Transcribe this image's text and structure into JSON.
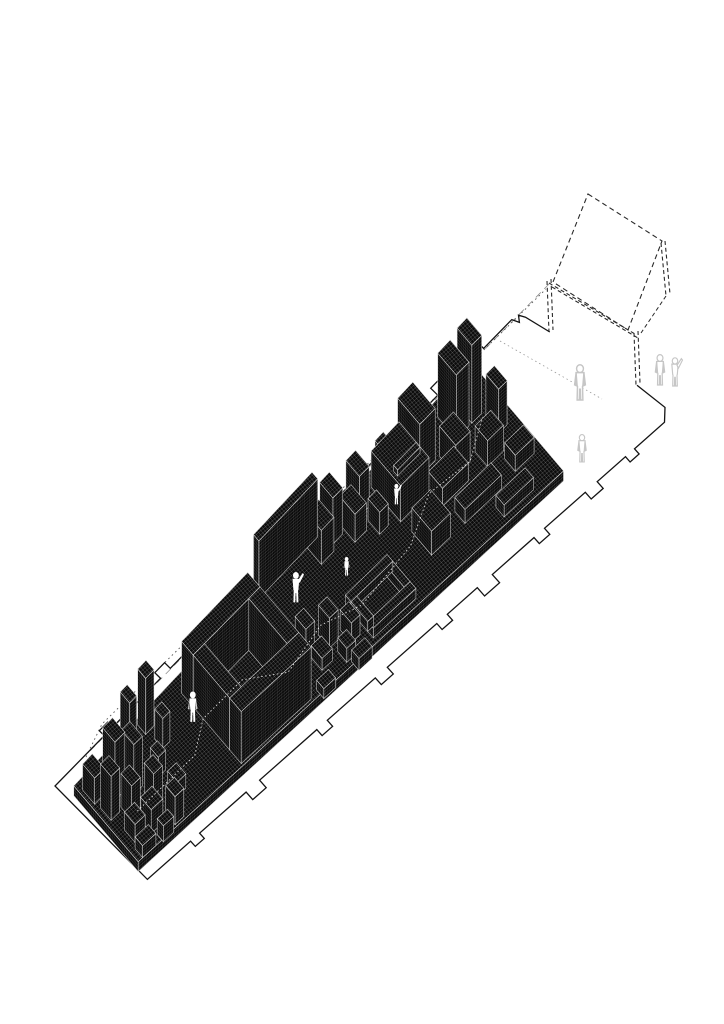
{
  "meta": {
    "title": "Axonometric site massing diagram",
    "description": "Black cross-hatched axonometric building massing on a long notched site plan, with dashed construction planes at the upper right and small human silhouettes"
  },
  "canvas": {
    "width": 724,
    "height": 1024,
    "background": "#ffffff"
  },
  "palette": {
    "line": "#141414",
    "dashed": "#2a2a2a",
    "construction_dash": "#8e8e8e",
    "construction_dot": "#555555",
    "leader": "#9a9a9a",
    "mass_fill": "#0c0c0c",
    "hatch_line": "#ffffff",
    "route_dot": "#ffffff",
    "ghost_outline": "#c6c6c6",
    "figure_fill": "#ffffff"
  },
  "axes": {
    "origin": [
      55,
      786
    ],
    "u": [
      0.7625,
      -0.6471
    ],
    "v": [
      0.6471,
      0.7625
    ],
    "strip_length": 650,
    "edge_nw": {
      "v0": 16,
      "dv": -76
    },
    "edge_se": {
      "v0": 131,
      "dv": -20
    }
  },
  "boundary": {
    "stroke_width": 1.3,
    "segments": [
      {
        "type": "line",
        "pts": [
          [
            703,
            71
          ],
          [
            710,
            106
          ],
          [
            700,
            117
          ]
        ]
      },
      {
        "type": "tabbed",
        "from": [
          700,
          117
        ],
        "to": [
          10,
          131
        ],
        "normal": [
          0.02,
          1
        ],
        "tabs": [
          [
            0.058,
            12,
            7
          ],
          [
            0.13,
            16,
            9
          ],
          [
            0.232,
            14,
            8
          ],
          [
            0.333,
            20,
            11
          ],
          [
            0.42,
            14,
            8
          ],
          [
            0.536,
            16,
            9
          ],
          [
            0.652,
            14,
            8
          ],
          [
            0.783,
            18,
            10
          ],
          [
            0.899,
            12,
            7
          ]
        ]
      },
      {
        "type": "line",
        "pts": [
          [
            10,
            131
          ],
          [
            0,
            0
          ]
        ]
      },
      {
        "type": "tabbed",
        "from": [
          0,
          0
        ],
        "to": [
          650,
          -60
        ],
        "normal": [
          -0.09,
          -0.996
        ],
        "tabs": [
          [
            0.108,
            12,
            7
          ],
          [
            0.231,
            14,
            8
          ],
          [
            0.346,
            16,
            9
          ],
          [
            0.462,
            20,
            11
          ],
          [
            0.569,
            14,
            8
          ],
          [
            0.662,
            16,
            9
          ],
          [
            0.738,
            14,
            8
          ],
          [
            0.838,
            18,
            10
          ],
          [
            0.923,
            10,
            6
          ]
        ]
      },
      {
        "type": "line",
        "pts": [
          [
            654,
            -53
          ],
          [
            658,
            -59
          ],
          [
            662,
            -53
          ],
          [
            671,
            -26
          ]
        ]
      }
    ]
  },
  "construction": {
    "dotted_boundary": [
      [
        86,
        757
      ],
      [
        102,
        724
      ],
      [
        546,
        289
      ]
    ],
    "dash_line": [
      [
        90,
        751
      ],
      [
        550,
        283
      ]
    ],
    "leader": [
      [
        500,
        341
      ],
      [
        602,
        399
      ]
    ],
    "panel": [
      [
        588,
        194
      ],
      [
        662,
        241
      ],
      [
        628,
        330
      ],
      [
        553,
        282
      ]
    ],
    "double_dash": [
      [
        [
          547,
          281
        ],
        [
          549,
          332
        ]
      ],
      [
        [
          551,
          279
        ],
        [
          553,
          330
        ]
      ],
      [
        [
          634,
          333
        ],
        [
          636,
          385
        ]
      ],
      [
        [
          638,
          331
        ],
        [
          640,
          383
        ]
      ],
      [
        [
          549,
          283
        ],
        [
          635,
          334
        ]
      ],
      [
        [
          552,
          287
        ],
        [
          638,
          338
        ]
      ],
      [
        [
          661,
          243
        ],
        [
          666,
          296
        ]
      ],
      [
        [
          665,
          241
        ],
        [
          670,
          294
        ]
      ]
    ],
    "single_dash": [
      [
        666,
        296
      ],
      [
        641,
        333
      ]
    ]
  },
  "massing": {
    "plinth": {
      "s0": 8,
      "s1": 585,
      "t0": 4,
      "t1": 90,
      "h": 10
    },
    "boxes": [
      [
        12,
        12,
        14,
        16,
        26
      ],
      [
        14,
        34,
        12,
        14,
        44
      ],
      [
        30,
        22,
        14,
        16,
        58
      ],
      [
        30,
        46,
        12,
        14,
        34
      ],
      [
        48,
        30,
        12,
        16,
        50
      ],
      [
        18,
        62,
        14,
        14,
        18
      ],
      [
        36,
        66,
        16,
        14,
        24
      ],
      [
        52,
        56,
        12,
        12,
        38
      ],
      [
        14,
        80,
        18,
        10,
        12
      ],
      [
        40,
        84,
        14,
        8,
        16
      ],
      [
        60,
        76,
        12,
        12,
        28
      ],
      [
        64,
        14,
        10,
        12,
        62
      ],
      [
        78,
        40,
        10,
        10,
        20
      ],
      [
        80,
        60,
        12,
        12,
        14
      ],
      [
        96,
        8,
        12,
        10,
        56
      ],
      [
        100,
        26,
        10,
        10,
        30
      ],
      [
        150,
        16,
        95,
        14,
        52
      ],
      [
        150,
        74,
        95,
        14,
        52
      ],
      [
        150,
        30,
        16,
        44,
        52
      ],
      [
        229,
        30,
        16,
        44,
        52
      ],
      [
        270,
        3,
        85,
        6,
        58
      ],
      [
        255,
        55,
        12,
        12,
        16
      ],
      [
        272,
        48,
        12,
        12,
        22
      ],
      [
        272,
        66,
        14,
        12,
        12
      ],
      [
        292,
        58,
        12,
        12,
        30
      ],
      [
        296,
        76,
        12,
        10,
        14
      ],
      [
        312,
        66,
        12,
        12,
        20
      ],
      [
        255,
        86,
        16,
        8,
        10
      ],
      [
        300,
        88,
        18,
        8,
        12
      ],
      [
        332,
        56,
        58,
        6,
        10
      ],
      [
        332,
        80,
        58,
        6,
        10
      ],
      [
        332,
        62,
        8,
        18,
        10
      ],
      [
        382,
        62,
        8,
        18,
        10
      ],
      [
        340,
        8,
        18,
        16,
        34
      ],
      [
        362,
        6,
        14,
        14,
        46
      ],
      [
        380,
        14,
        16,
        16,
        28
      ],
      [
        400,
        6,
        14,
        14,
        40
      ],
      [
        404,
        26,
        12,
        12,
        22
      ],
      [
        428,
        12,
        40,
        30,
        36
      ],
      [
        430,
        52,
        26,
        20,
        24
      ],
      [
        472,
        8,
        22,
        22,
        52
      ],
      [
        470,
        40,
        36,
        14,
        18
      ],
      [
        476,
        62,
        50,
        10,
        14
      ],
      [
        500,
        30,
        20,
        16,
        30
      ],
      [
        524,
        12,
        18,
        18,
        64
      ],
      [
        546,
        16,
        14,
        14,
        78
      ],
      [
        530,
        44,
        22,
        12,
        26
      ],
      [
        548,
        60,
        26,
        10,
        16
      ],
      [
        560,
        34,
        12,
        12,
        44
      ],
      [
        510,
        78,
        40,
        8,
        12
      ],
      [
        448,
        2,
        12,
        8,
        20
      ],
      [
        500,
        2,
        10,
        8,
        24
      ],
      [
        432,
        16,
        32,
        4,
        6,
        46
      ],
      [
        432,
        32,
        32,
        4,
        6,
        46
      ],
      [
        460,
        20,
        4,
        12,
        6,
        46
      ]
    ],
    "route": [
      [
        40,
        58
      ],
      [
        120,
        58
      ],
      [
        150,
        42
      ],
      [
        205,
        42
      ],
      [
        245,
        62
      ],
      [
        300,
        54
      ],
      [
        345,
        64
      ],
      [
        420,
        58
      ],
      [
        468,
        42
      ],
      [
        520,
        46
      ],
      [
        558,
        32
      ]
    ]
  },
  "figures": {
    "white": [
      [
        140,
        38,
        31,
        "stand"
      ],
      [
        296,
        30,
        31,
        "wave"
      ],
      [
        352,
        42,
        19,
        "stand"
      ],
      [
        436,
        32,
        21,
        "wave"
      ]
    ],
    "ghost": [
      [
        580,
        400,
        36,
        "stand"
      ],
      [
        582,
        462,
        28,
        "stand"
      ]
    ],
    "ghost_pair": [
      668,
      385,
      31
    ]
  }
}
